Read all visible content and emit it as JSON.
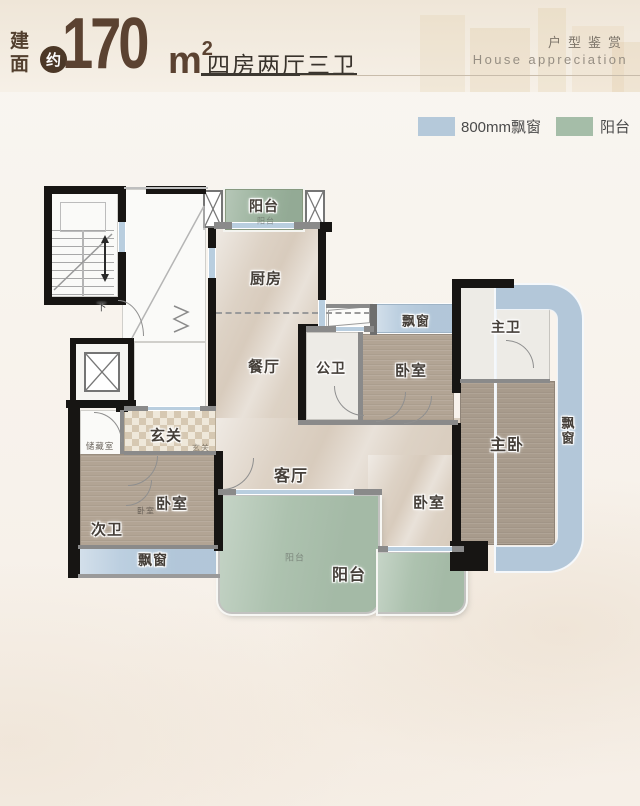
{
  "header": {
    "area_label": "建面",
    "approx_badge": "约",
    "area_value": "170",
    "area_unit": "m",
    "area_unit_sup": "2",
    "layout_summary": "四房两厅三卫",
    "series_title_cn": "户型鉴赏",
    "series_title_en": "House appreciation"
  },
  "legend": {
    "bay_window": {
      "label": "800mm飘窗",
      "color": "#b5c9da"
    },
    "balcony": {
      "label": "阳台",
      "color": "#a5bda8"
    }
  },
  "floorplan": {
    "labels": {
      "balcony_top": "阳台",
      "balcony_top_mark": "阳台",
      "kitchen": "厨房",
      "dining": "餐厅",
      "public_bath": "公卫",
      "bay_top": "飘窗",
      "bedroom_mid": "卧室",
      "master_bath": "主卫",
      "master_bedroom": "主卧",
      "bay_right": "飘窗",
      "foyer": "玄关",
      "foyer_mark": "玄关",
      "storage": "储藏室",
      "bedroom_left": "卧室",
      "bedroom_left_mark": "卧室",
      "second_bath": "次卫",
      "bay_left": "飘窗",
      "living": "客厅",
      "bedroom_bottom": "卧室",
      "balcony_bottom": "阳台",
      "balcony_bottom_mark": "阳台",
      "stair_down": "下"
    }
  },
  "colors": {
    "accent_brown": "#5b4231",
    "bay_blue": "#b5c9da",
    "balcony_green": "#a5bda8",
    "wall_black": "#171513"
  }
}
